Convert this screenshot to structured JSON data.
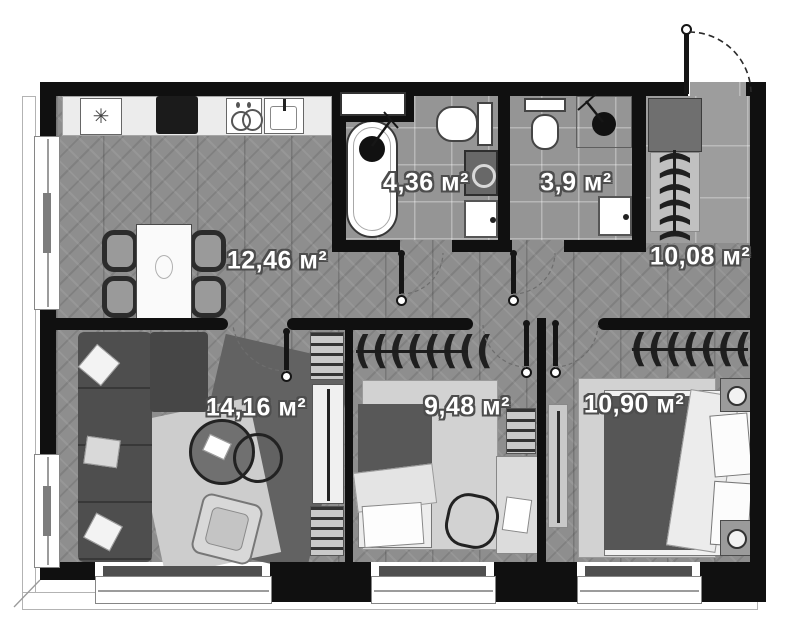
{
  "plan": {
    "unit": "м²",
    "rooms": [
      {
        "id": "kitchen-living",
        "label": "12,46 м²"
      },
      {
        "id": "bathroom-main",
        "label": "4,36 м²"
      },
      {
        "id": "bathroom-guest",
        "label": "3,9 м²"
      },
      {
        "id": "hallway",
        "label": "10,08 м²"
      },
      {
        "id": "living-room",
        "label": "14,16 м²"
      },
      {
        "id": "bedroom-small",
        "label": "9,48 м²"
      },
      {
        "id": "bedroom-master",
        "label": "10,90 м²"
      }
    ],
    "icons": {
      "hangers_row": "((((((((",
      "hangers_col": "((((((",
      "snowflake": "✳"
    },
    "colors": {
      "wall": "#101010",
      "wood_floor": "#8e8e8e",
      "tile_floor": "#969696",
      "furniture_dark": "#4e4e4e",
      "furniture_light": "#d8d8d8",
      "paper": "#ffffff"
    }
  }
}
